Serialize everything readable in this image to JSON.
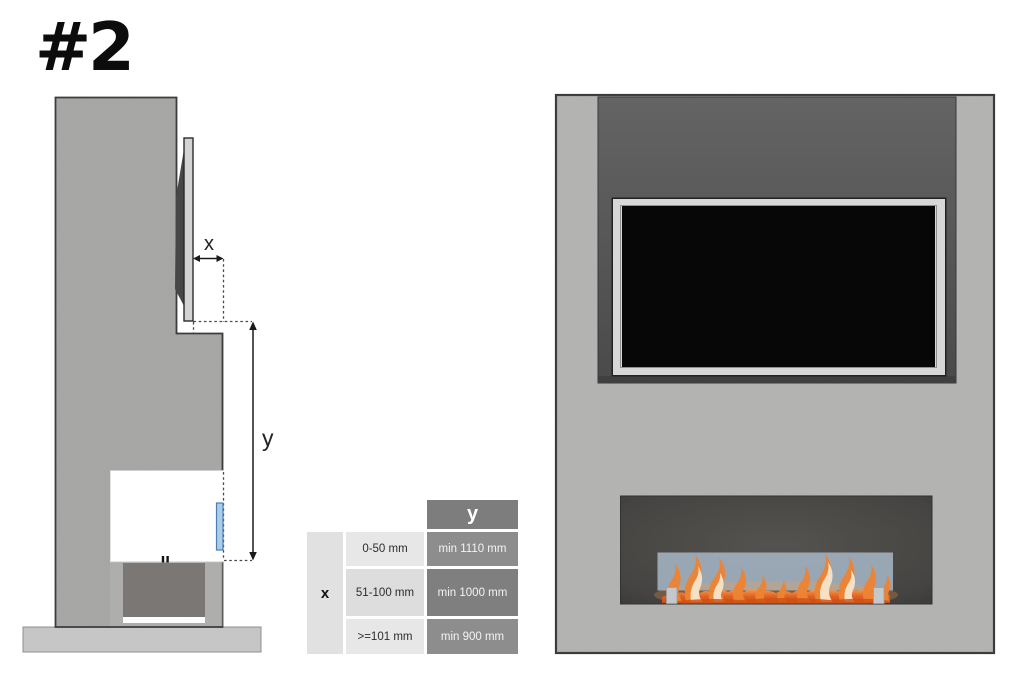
{
  "page": {
    "title_label": "#2"
  },
  "colors": {
    "canvas_bg": "#ffffff",
    "wall_side": "#a8a8a7",
    "wall_side_lower": "#b3b3b1",
    "wall_front": "#b5b6b4",
    "outline_dark": "#3a3a3a",
    "tv_niche_dark": "#545454",
    "tv_frame_silver": "#d7d7d7",
    "tv_screen_black": "#070707",
    "tv_side_panel": "#d3d3d3",
    "tv_side_back": "#474747",
    "cavity_white": "#ffffff",
    "recess_dark": "#7b7774",
    "floor_gray": "#c6c6c6",
    "opening_dark": "#484644",
    "glass_blue_front": "#a4b4c3",
    "glass_blue_side": "#aecbe8",
    "glass_border_side": "#4b7fb5",
    "bracket_gray": "#c5c8ca",
    "flame_deep": "#cf5215",
    "flame_mid": "#ee8434",
    "flame_light": "#f6b06a",
    "flame_cream": "#f8e8d0",
    "dotted_line": "#4a4a4a",
    "dim_line": "#1a1a1a",
    "label_text": "#222222",
    "table_header_bg": "#7d7d7d",
    "table_header_text": "#ffffff",
    "table_x_bg": "#e1e1e1",
    "table_mid_bg_a": "#e7e7e7",
    "table_mid_bg_b": "#dddddd",
    "table_val_bg_a": "#8d8d8d",
    "table_val_bg_b": "#7f7f7f",
    "table_text_dark": "#2c2c2c",
    "table_text_light": "#f4f4f4"
  },
  "side_view": {
    "x_label": "x",
    "y_label": "y"
  },
  "table": {
    "col_header": "y",
    "row_header": "x",
    "rows": [
      {
        "x_range": "0-50 mm",
        "y_min": "min 1110 mm"
      },
      {
        "x_range": "51-100 mm",
        "y_min": "min 1000 mm"
      },
      {
        "x_range": ">=101 mm",
        "y_min": "min 900 mm"
      }
    ]
  }
}
